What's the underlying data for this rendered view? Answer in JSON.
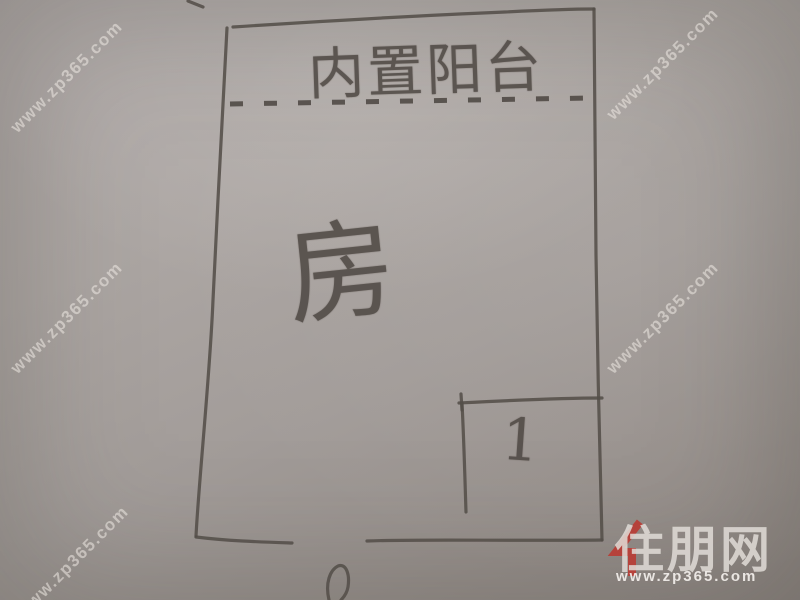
{
  "floor_plan": {
    "balcony_label": "内置阳台",
    "room_label": "房",
    "closet_label": "1"
  },
  "watermark": {
    "text": "www.zp365.com"
  },
  "logo": {
    "brand": "住朋网",
    "url": "www.zp365.com",
    "accent_color": "#b5423b",
    "text_color": "#e1dcd7"
  },
  "colors": {
    "paper": "#a8a2a0",
    "pencil": "#544e49",
    "watermark": "#eee9e4"
  }
}
